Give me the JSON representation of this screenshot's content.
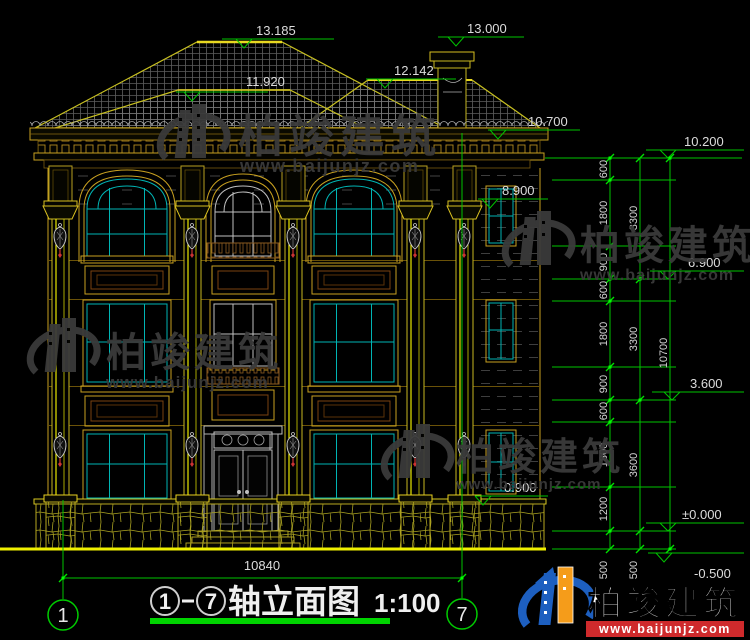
{
  "drawing": {
    "title": {
      "name": "轴立面图",
      "scale": "1:100"
    },
    "axes": {
      "left": "1",
      "right": "7"
    },
    "total_width": "10840",
    "chain_total": "10700",
    "chain_inner": [
      "600",
      "1800",
      "900",
      "600",
      "1800",
      "900",
      "600",
      "1800",
      "1200",
      "500"
    ],
    "chain_mid": [
      "3300",
      "3300",
      "3600",
      "500"
    ],
    "elevations": {
      "ridge": "13.185",
      "chimney": "13.000",
      "ridge2": "12.142",
      "ridge3": "11.920",
      "eave": "10.700",
      "parapet": "10.200",
      "cornice": "8.900",
      "floor3": "6.900",
      "floor2": "3.600",
      "plinth": "0.900",
      "zero": "±0.000",
      "grade": "-0.500"
    }
  },
  "watermark": {
    "brand": "柏竣建筑",
    "url": "www.baijunjz.com"
  },
  "logo": {
    "brand": "柏竣建筑",
    "url": "www.baijunjz.com"
  }
}
